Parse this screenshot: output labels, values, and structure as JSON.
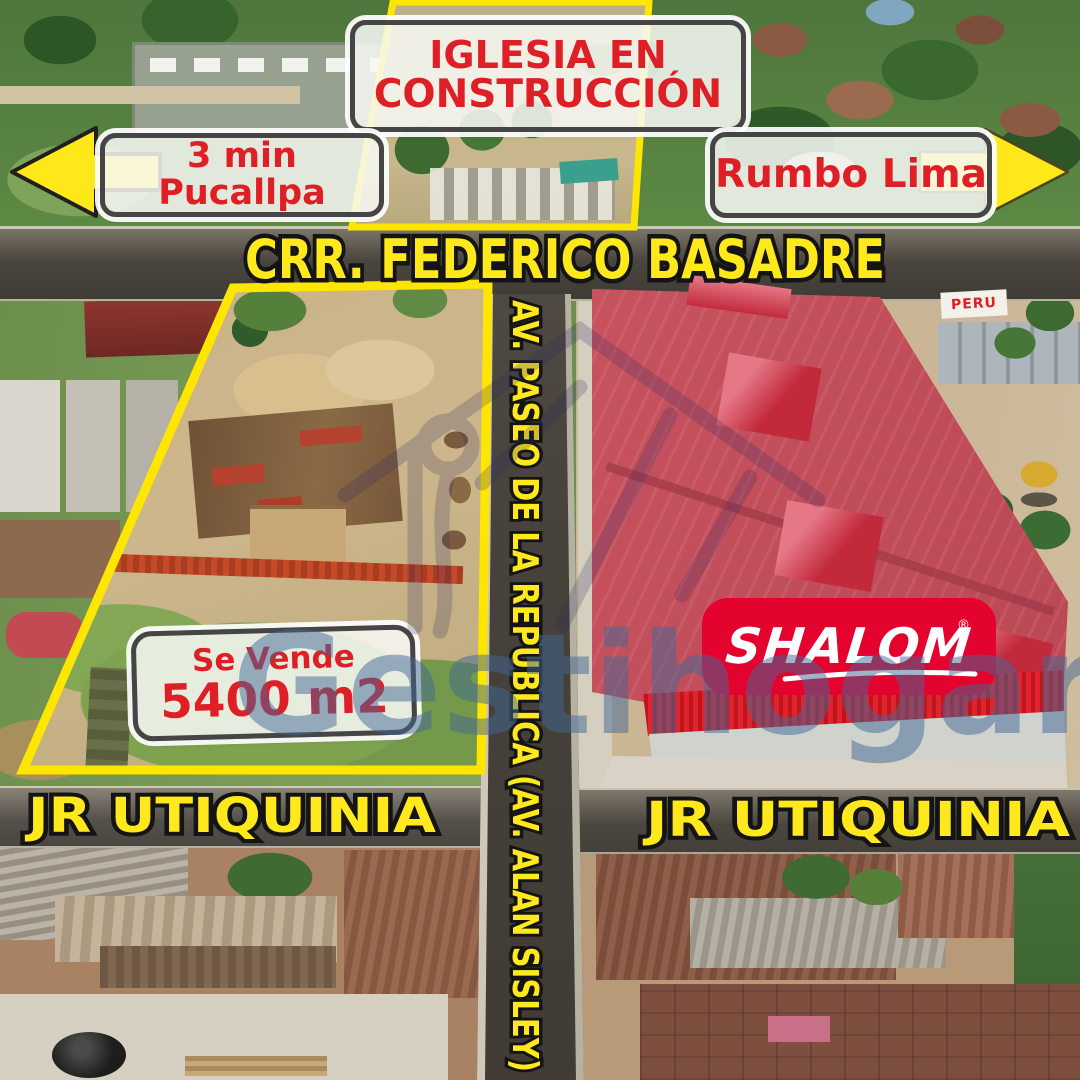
{
  "labels": {
    "church": {
      "line1": "IGLESIA EN",
      "line2": "CONSTRUCCIÓN"
    },
    "pucallpa": "3 min Pucallpa",
    "rumbo": "Rumbo Lima"
  },
  "roads": {
    "highway": "CRR. FEDERICO BASADRE",
    "avenue": "AV. PASEO DE LA REPUBLICA (AV. ALAN SISLEY)",
    "street_left": "JR UTIQUINIA",
    "street_right": "JR UTIQUINIA"
  },
  "property": {
    "sale_title": "Se Vende",
    "sale_area": "5400 m2"
  },
  "shalom": {
    "text": "SHALOM",
    "reg": "®"
  },
  "signs": {
    "peru": "PERU"
  },
  "watermark": {
    "text": "Gestihogar"
  },
  "colors": {
    "accent_yellow": "#FFE81A",
    "label_red": "#DF1F26",
    "box_border": "#454545",
    "box_bg": "#F8F9F6",
    "shalom_red": "#E4032E",
    "shalom_text": "#FFFFFF",
    "road_dark": "#4A453E",
    "outline_yellow": "#FFE600",
    "roof_pink": "#C8535F",
    "eave_red": "#E3232B",
    "watermark_blue": "#426896"
  }
}
